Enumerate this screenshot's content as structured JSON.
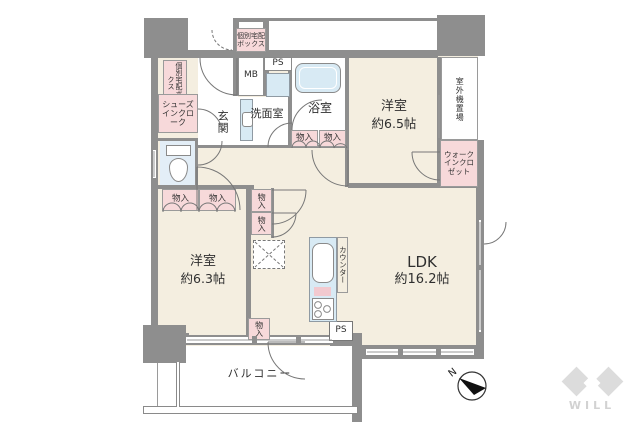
{
  "rooms": [
    {
      "name": "洋室",
      "size": "約6.5帖"
    },
    {
      "name": "洋室",
      "size": "約6.3帖"
    },
    {
      "name": "LDK",
      "size": "約16.2帖"
    }
  ],
  "labels": {
    "delivery_box_side": "個別宅配ボックス",
    "delivery_box_top": "個別宅配ボックス",
    "meter_box": "MB",
    "pipe_space_top": "PS",
    "pipe_space_bottom": "PS",
    "shoes_in_cloak": "シューズインクローク",
    "entrance": "玄関",
    "washroom": "洗面室",
    "bathroom": "浴室",
    "storage": "物入",
    "outdoor_unit": "室外機置場",
    "walk_in_closet": "ウォークインクロゼット",
    "counter": "カウンター",
    "balcony": "バルコニー",
    "compass_north": "N",
    "brand": "WILL"
  },
  "colors": {
    "wall": "#8e8e8e",
    "floor": "#f4eee0",
    "storage_pink": "#f7d9da",
    "water_blue": "#d8eaf4",
    "logo_gray": "#dcdcdc",
    "background": "#ffffff"
  }
}
